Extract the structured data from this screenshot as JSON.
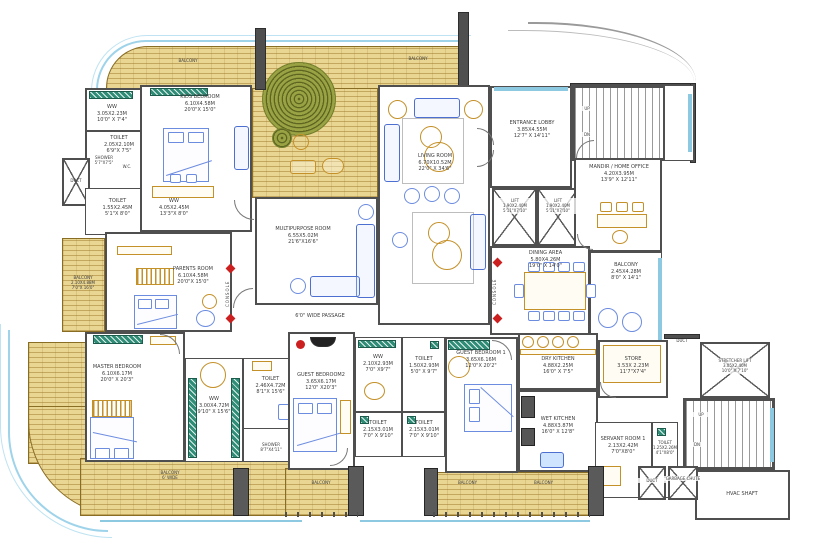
{
  "plan": {
    "rooms": {
      "kids": {
        "name": "KIDS BEDROOM",
        "m": "6.10X4.58M",
        "ft": "20'0\"X 15'0\""
      },
      "ww_tl": {
        "name": "WW",
        "m": "3.05X2.23M",
        "ft": "10'0\" X 7'4\""
      },
      "toilet_tl": {
        "name": "TOILET",
        "m": "2.05X2.10M",
        "ft": "6'9\"X 7'5\""
      },
      "shower_tl": {
        "name": "SHOWER",
        "ft": "5'7\"X7'5\""
      },
      "wc_tl": {
        "name": "W.C."
      },
      "toilet_ml": {
        "name": "TOILET",
        "m": "1.55X2.45M",
        "ft": "5'1\"X 8'0\""
      },
      "ww_ml": {
        "name": "WW",
        "m": "4.05X2.45M",
        "ft": "13'3\"X 8'0\""
      },
      "parents": {
        "name": "PARENTS ROOM",
        "m": "6.10X4.58M",
        "ft": "20'0\"X 15'0\""
      },
      "multipurpose": {
        "name": "MULTIPURPOSE  ROOM",
        "m": "6.55X5.02M",
        "ft": "21'6\"X16'6\""
      },
      "living": {
        "name": "LIVING ROOM",
        "m": "6.70X10.52M",
        "ft": "22'0\" X 34'6\""
      },
      "entrance": {
        "name": "ENTRANCE LOBBY",
        "m": "3.85X4.55M",
        "ft": "12'7\" X 14'11\""
      },
      "lift": {
        "name": "LIFT",
        "m": "1.90X2.40M",
        "ft": "5'11\"X7'10\""
      },
      "mandir": {
        "name": "MANDIR / HOME OFFICE",
        "m": "4.20X3.95M",
        "ft": "13'9\" X 12'11\""
      },
      "dining": {
        "name": "DINING AREA",
        "m": "5.80X4.26M",
        "ft": "19'0\" X 14'0\""
      },
      "master": {
        "name": "MASTER BEDROOM",
        "m": "6.10X6.17M",
        "ft": "20'0\" X 20'3\""
      },
      "ww_master": {
        "name": "WW",
        "m": "3.00X4.72M",
        "ft": "9'10\" X 15'6\""
      },
      "toilet_master": {
        "name": "TOILET",
        "m": "2.46X4.72M",
        "ft": "8'1\"X 15'6\""
      },
      "shower_master": {
        "name": "SHOWER",
        "ft": "8'7\"X4'11\""
      },
      "guest2": {
        "name": "GUEST BEDROOM2",
        "m": "3.65X6.17M",
        "ft": "12'0\" X20'3\""
      },
      "ww_guest": {
        "name": "WW",
        "m": "2.10X2.93M",
        "ft": "7'0\" X9'7\""
      },
      "toilet_g1": {
        "name": "TOILET",
        "m": "1.50X2.93M",
        "ft": "5'0\" X 9'7\""
      },
      "toilet_g2": {
        "name": "TOILET",
        "m": "2.15X3.01M",
        "ft": "7'0\" X 9'10\""
      },
      "toilet_g3": {
        "name": "TOILET",
        "m": "2.15X3.01M",
        "ft": "7'0\" X 9'10\""
      },
      "guest1": {
        "name": "GUEST BEDROOM 1",
        "m": "3.65X6.16M",
        "ft": "12'0\"X 20'2\""
      },
      "dry_kitchen": {
        "name": "DRY KITCHEN",
        "m": "4.88X2.25M",
        "ft": "16'0\" X 7'5\""
      },
      "wet_kitchen": {
        "name": "WET KITCHEN",
        "m": "4.88X3.87M",
        "ft": "16'0\" X 12'8\""
      },
      "store": {
        "name": "STORE",
        "m": "3.53X 2.23M",
        "ft": "11'7\"X7'4\""
      },
      "servant": {
        "name": "SERVANT ROOM 1",
        "m": "2.13X2.42M",
        "ft": "7'0\"X8'0\""
      },
      "toilet_sv": {
        "name": "TOILET",
        "m": "1.25X2.26M",
        "ft": "4'1\"X8'0\""
      },
      "stretcher": {
        "name": "STRETCHER LIFT",
        "m": "3.05X2.40M",
        "ft": "10'0\" X 7'10\""
      },
      "hvac": {
        "name": "HVAC SHAFT"
      },
      "garbage": {
        "name": "GARBAGE CHUTE"
      }
    },
    "balconies": {
      "top_left": {
        "name": "BALCONY"
      },
      "top_right": {
        "name": "BALCONY"
      },
      "left": {
        "name": "BALCONY",
        "m": "2.10X4.88M",
        "ft": "7'0\"X 16'0\""
      },
      "master": {
        "name": "BALCONY",
        "note": "6' WIDE"
      },
      "guest2": {
        "name": "BALCONY"
      },
      "guest1": {
        "name": "BALCONY"
      },
      "kitchen": {
        "name": "BALCONY"
      },
      "right": {
        "name": "BALCONY",
        "m": "2.45X4.28M",
        "ft": "8'0\" X 14'1\""
      }
    },
    "annotations": {
      "passage": "6'0\" WIDE PASSAGE",
      "console": "CONSOLE",
      "duct": "DUCT",
      "up": "UP",
      "dn": "DN"
    }
  }
}
